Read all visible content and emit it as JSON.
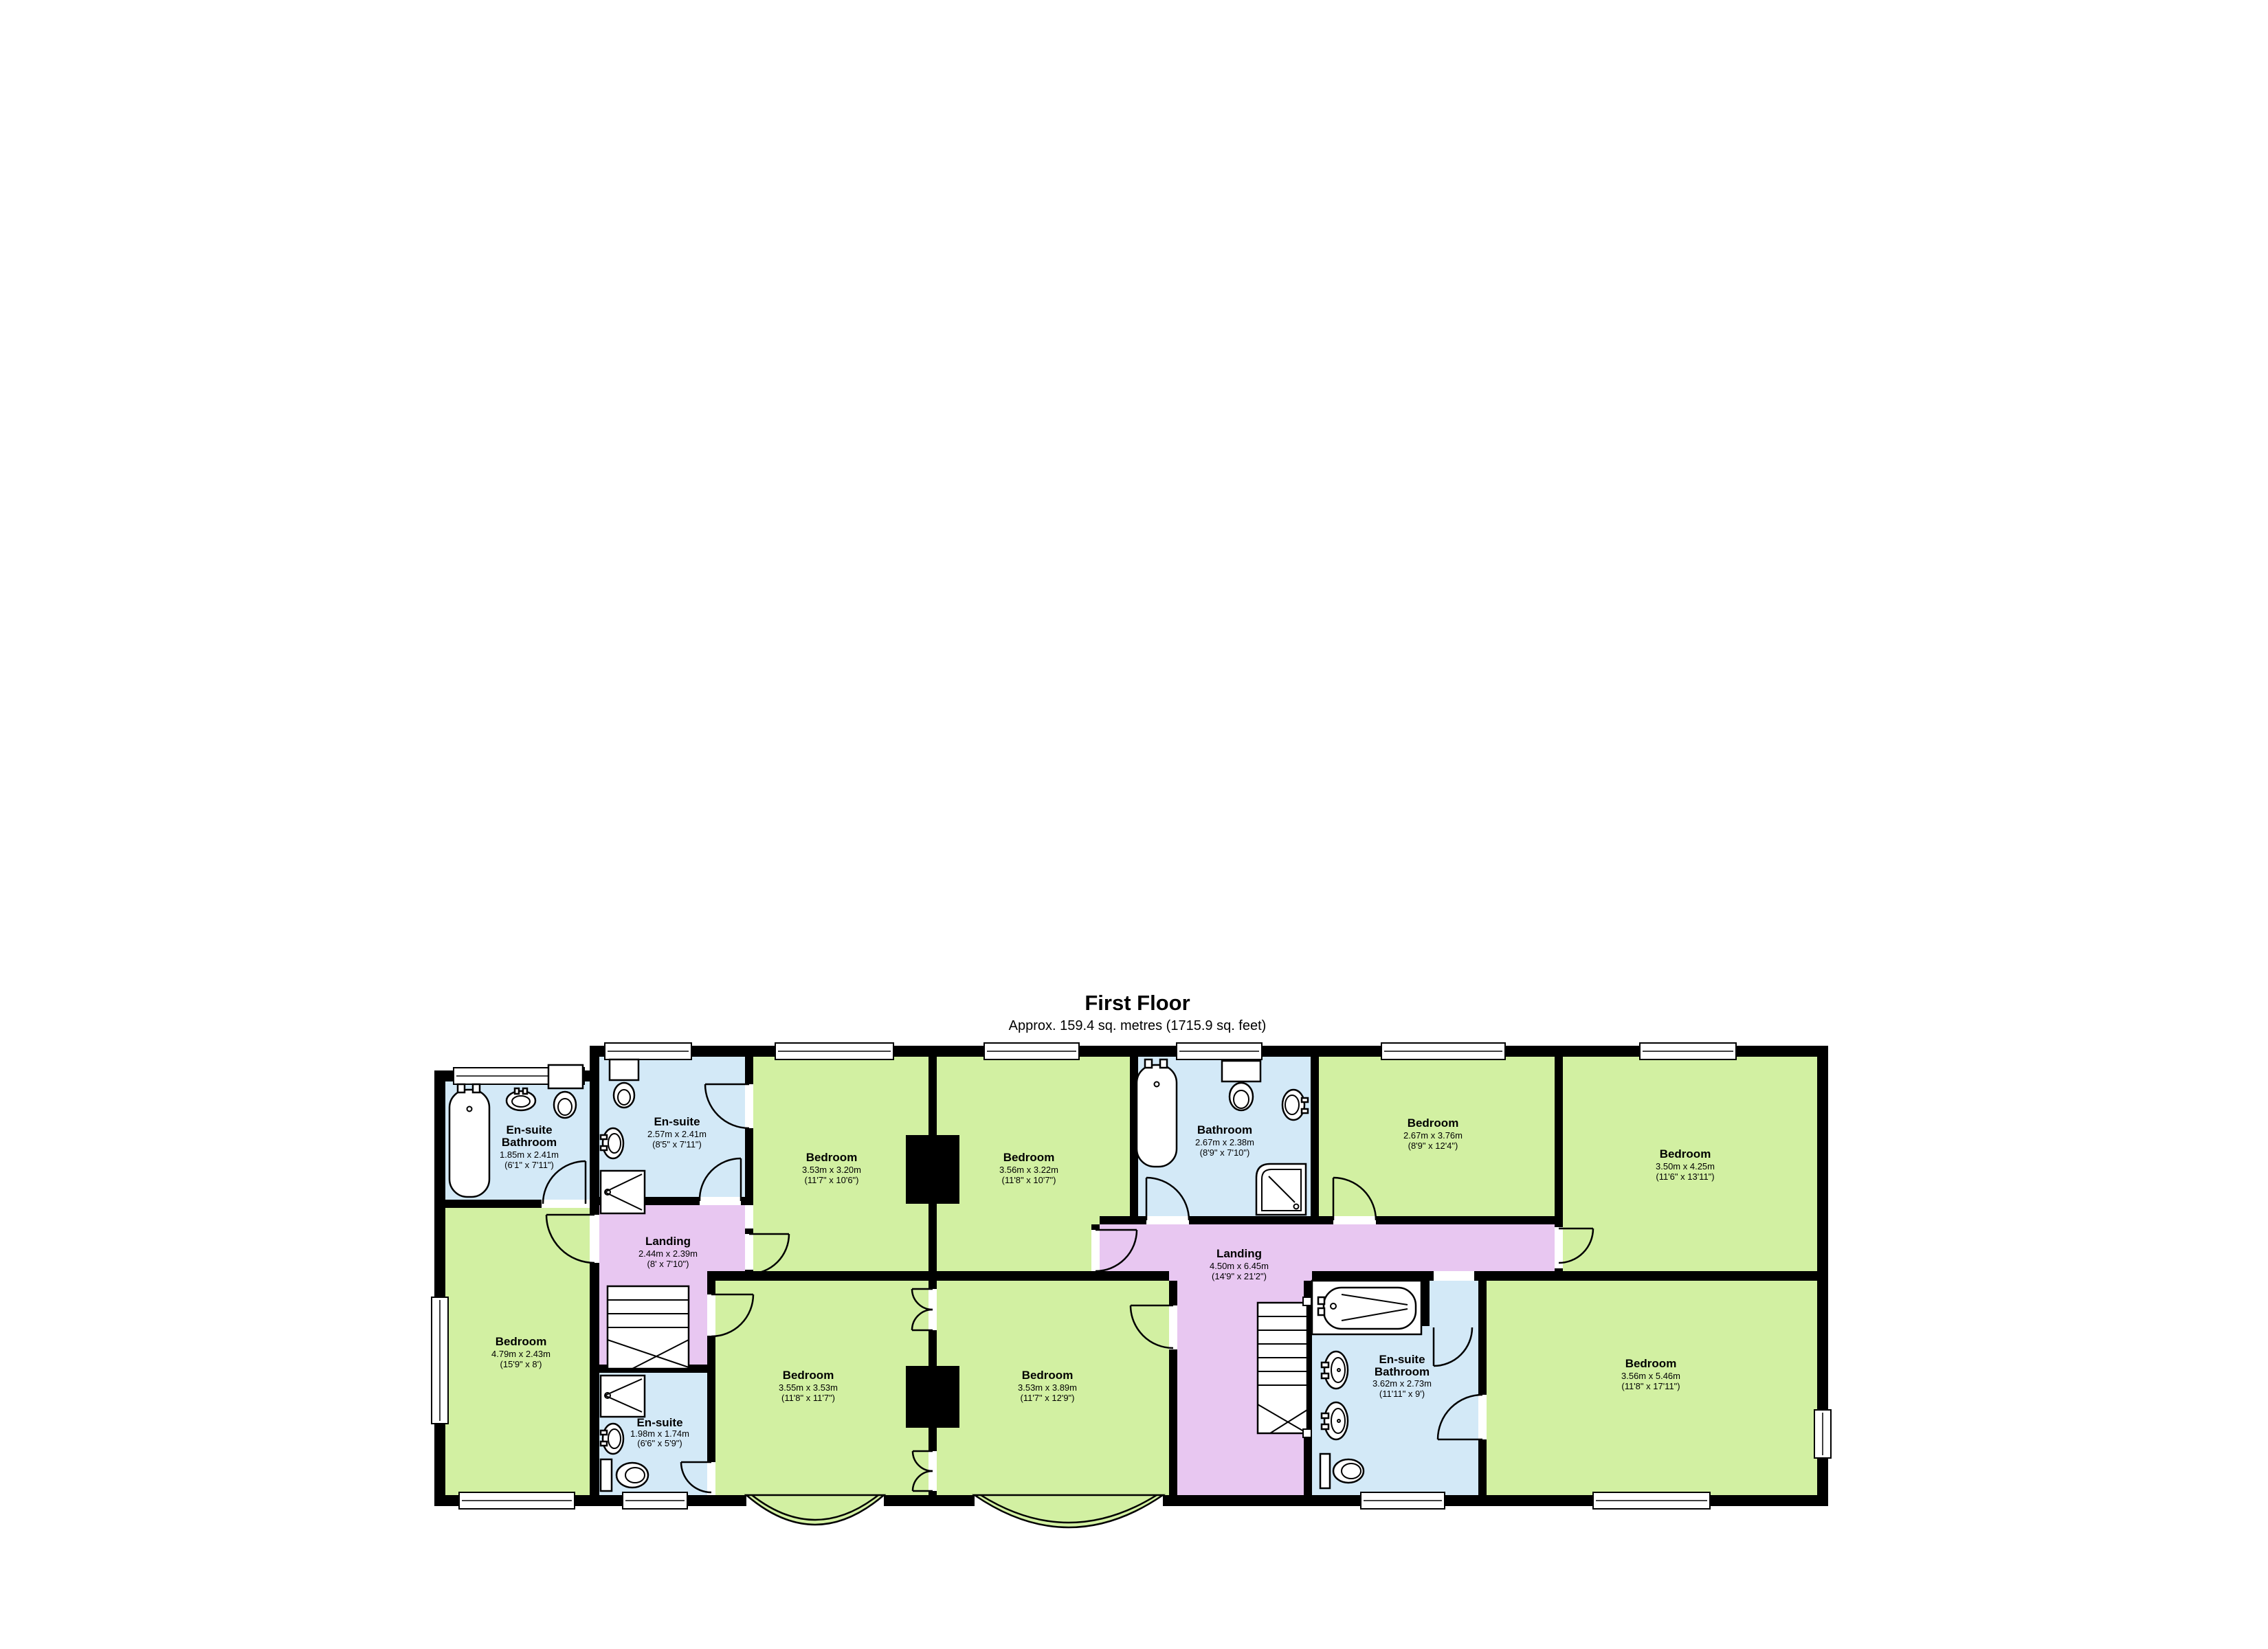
{
  "header": {
    "title": "First Floor",
    "subtitle": "Approx. 159.4 sq. metres (1715.9 sq. feet)"
  },
  "colors": {
    "room": "#d2f0a2",
    "wet": "#d3e9f7",
    "landing": "#e8c7f1",
    "wall": "#000000",
    "fixture": "#ffffff"
  },
  "rooms": {
    "ensuite_bathroom_left": {
      "name1": "En-suite",
      "name2": "Bathroom",
      "metric": "1.85m x 2.41m",
      "imperial": "(6'1\" x 7'11\")"
    },
    "ensuite_top": {
      "name1": "En-suite",
      "metric": "2.57m x 2.41m",
      "imperial": "(8'5\" x 7'11\")"
    },
    "bedroom_top_1": {
      "name1": "Bedroom",
      "metric": "3.53m x 3.20m",
      "imperial": "(11'7\" x 10'6\")"
    },
    "bedroom_top_2": {
      "name1": "Bedroom",
      "metric": "3.56m x 3.22m",
      "imperial": "(11'8\" x 10'7\")"
    },
    "bathroom": {
      "name1": "Bathroom",
      "metric": "2.67m x 2.38m",
      "imperial": "(8'9\" x 7'10\")"
    },
    "bedroom_top_3": {
      "name1": "Bedroom",
      "metric": "2.67m x 3.76m",
      "imperial": "(8'9\" x 12'4\")"
    },
    "bedroom_top_right": {
      "name1": "Bedroom",
      "metric": "3.50m x 4.25m",
      "imperial": "(11'6\" x 13'11\")"
    },
    "landing_small": {
      "name1": "Landing",
      "metric": "2.44m x 2.39m",
      "imperial": "(8' x 7'10\")"
    },
    "landing_main": {
      "name1": "Landing",
      "metric": "4.50m x 6.45m",
      "imperial": "(14'9\" x 21'2\")"
    },
    "bedroom_left": {
      "name1": "Bedroom",
      "metric": "4.79m x 2.43m",
      "imperial": "(15'9\" x 8')"
    },
    "ensuite_small": {
      "name1": "En-suite",
      "metric": "1.98m x 1.74m",
      "imperial": "(6'6\" x 5'9\")"
    },
    "bedroom_bottom_1": {
      "name1": "Bedroom",
      "metric": "3.55m x 3.53m",
      "imperial": "(11'8\" x 11'7\")"
    },
    "bedroom_bottom_2": {
      "name1": "Bedroom",
      "metric": "3.53m x 3.89m",
      "imperial": "(11'7\" x 12'9\")"
    },
    "ensuite_bathroom_right": {
      "name1": "En-suite",
      "name2": "Bathroom",
      "metric": "3.62m x 2.73m",
      "imperial": "(11'11\" x 9')"
    },
    "bedroom_bottom_right": {
      "name1": "Bedroom",
      "metric": "3.56m x 5.46m",
      "imperial": "(11'8\" x 17'11\")"
    }
  }
}
